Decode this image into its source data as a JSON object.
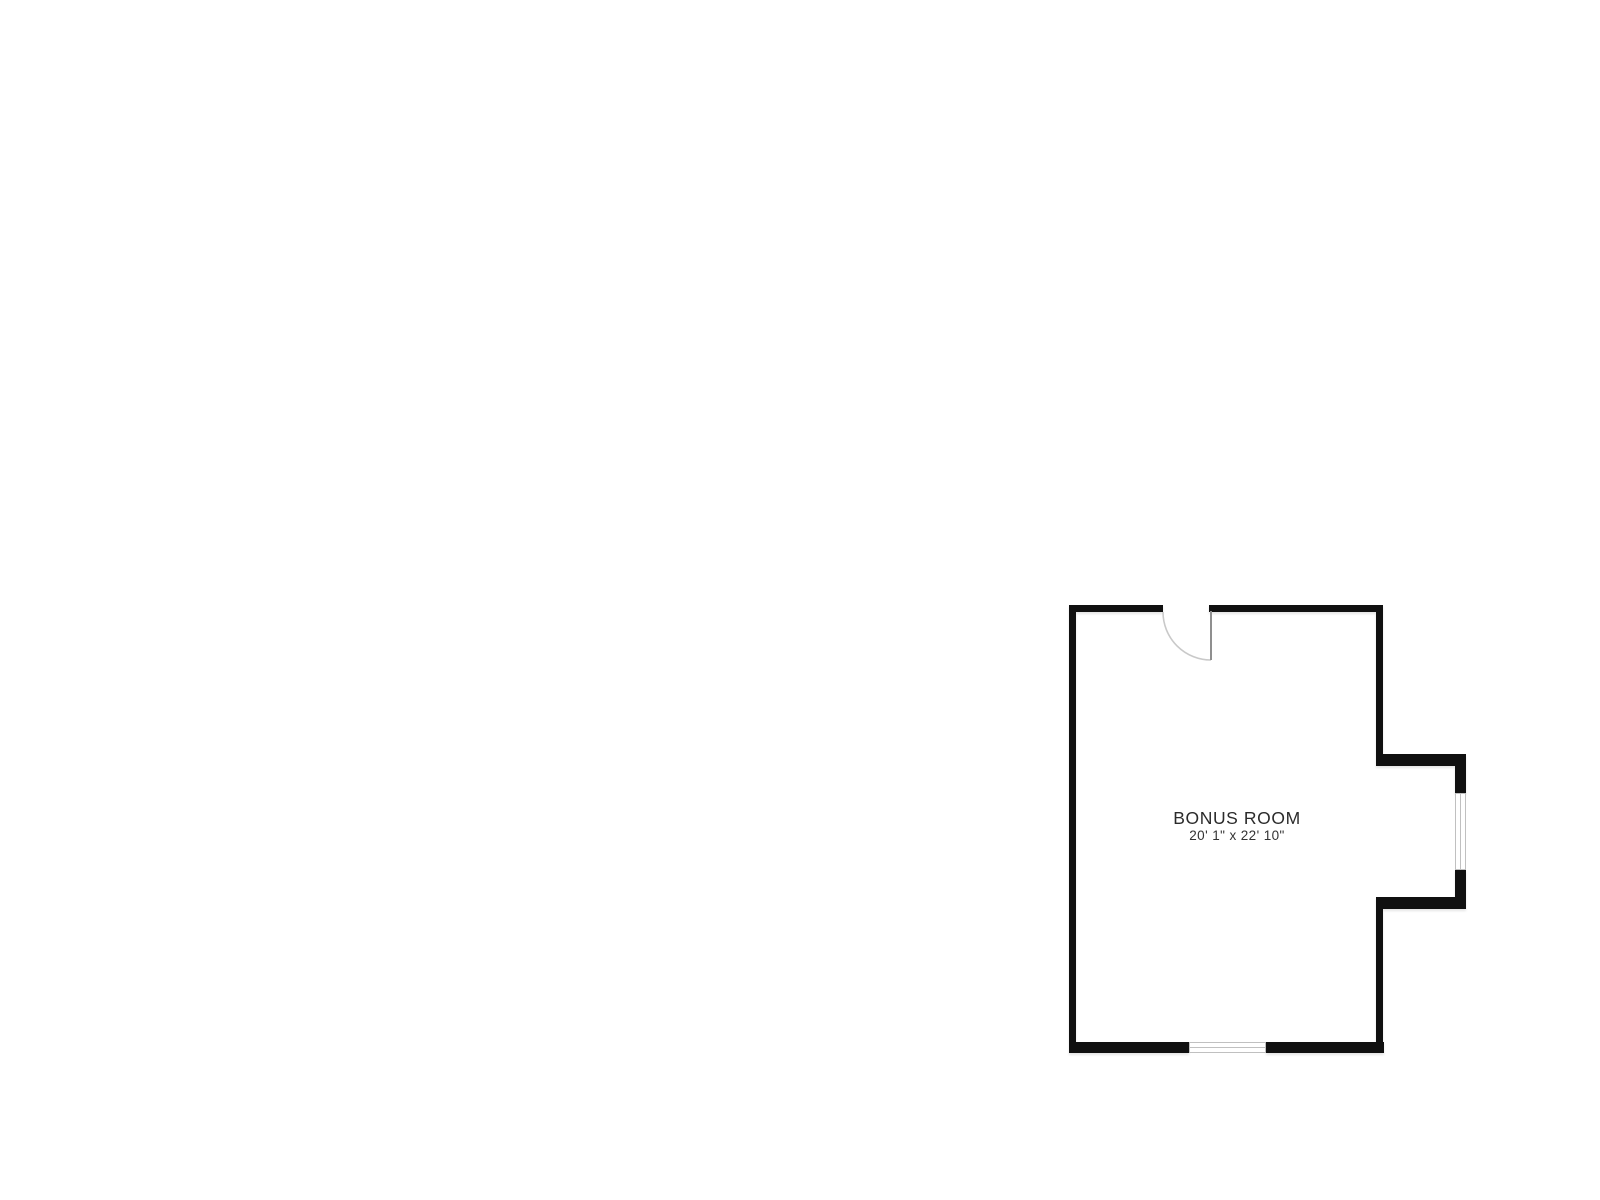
{
  "page": {
    "background": "#ffffff"
  },
  "floor_plan": {
    "room": {
      "name": "BONUS ROOM",
      "dimensions": "20' 1\" x 22' 10\""
    },
    "features": {
      "door": "door-with-swing-arc-top-wall",
      "window_right": "window-right-bump-out-wall",
      "window_bottom": "window-bottom-wall"
    },
    "colors": {
      "wall": "#101010",
      "window_frame": "#c0c0c0",
      "door_arc": "#c9c9c9",
      "door_leaf": "#8f8f8f",
      "label_text": "#2b2b2b",
      "background": "#ffffff"
    }
  }
}
